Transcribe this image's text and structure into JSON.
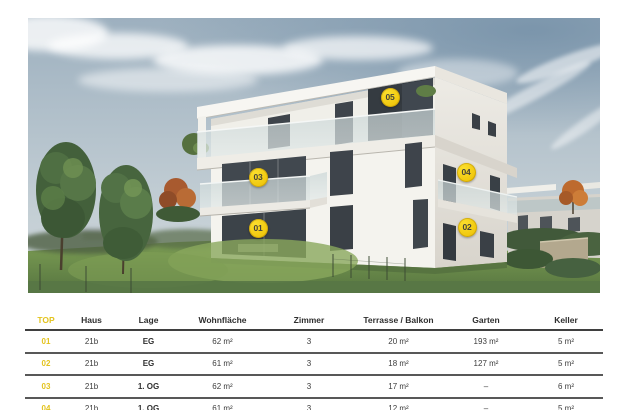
{
  "photo": {
    "markers": [
      {
        "label": "01",
        "x": 258,
        "y": 228
      },
      {
        "label": "02",
        "x": 467,
        "y": 227
      },
      {
        "label": "03",
        "x": 258,
        "y": 177
      },
      {
        "label": "04",
        "x": 466,
        "y": 172
      },
      {
        "label": "05",
        "x": 390,
        "y": 97
      }
    ]
  },
  "table": {
    "columns": [
      "TOP",
      "Haus",
      "Lage",
      "Wohnfläche",
      "Zimmer",
      "Terrasse / Balkon",
      "Garten",
      "Keller"
    ],
    "rows": [
      [
        "01",
        "21b",
        "EG",
        "62 m²",
        "3",
        "20 m²",
        "193 m²",
        "5 m²"
      ],
      [
        "02",
        "21b",
        "EG",
        "61 m²",
        "3",
        "18 m²",
        "127 m²",
        "5 m²"
      ],
      [
        "03",
        "21b",
        "1. OG",
        "62 m²",
        "3",
        "17 m²",
        "–",
        "6 m²"
      ],
      [
        "04",
        "21b",
        "1. OG",
        "61 m²",
        "3",
        "12 m²",
        "–",
        "5 m²"
      ]
    ]
  },
  "colors": {
    "accent_yellow": "#f1c90f",
    "table_accent_yellow": "#e3c31e",
    "marker_text": "#46443a",
    "header_text": "#2f2f2f",
    "body_text": "#3c3c3c",
    "rule_header": "#3f3f3f",
    "rule_row": "#585858"
  }
}
